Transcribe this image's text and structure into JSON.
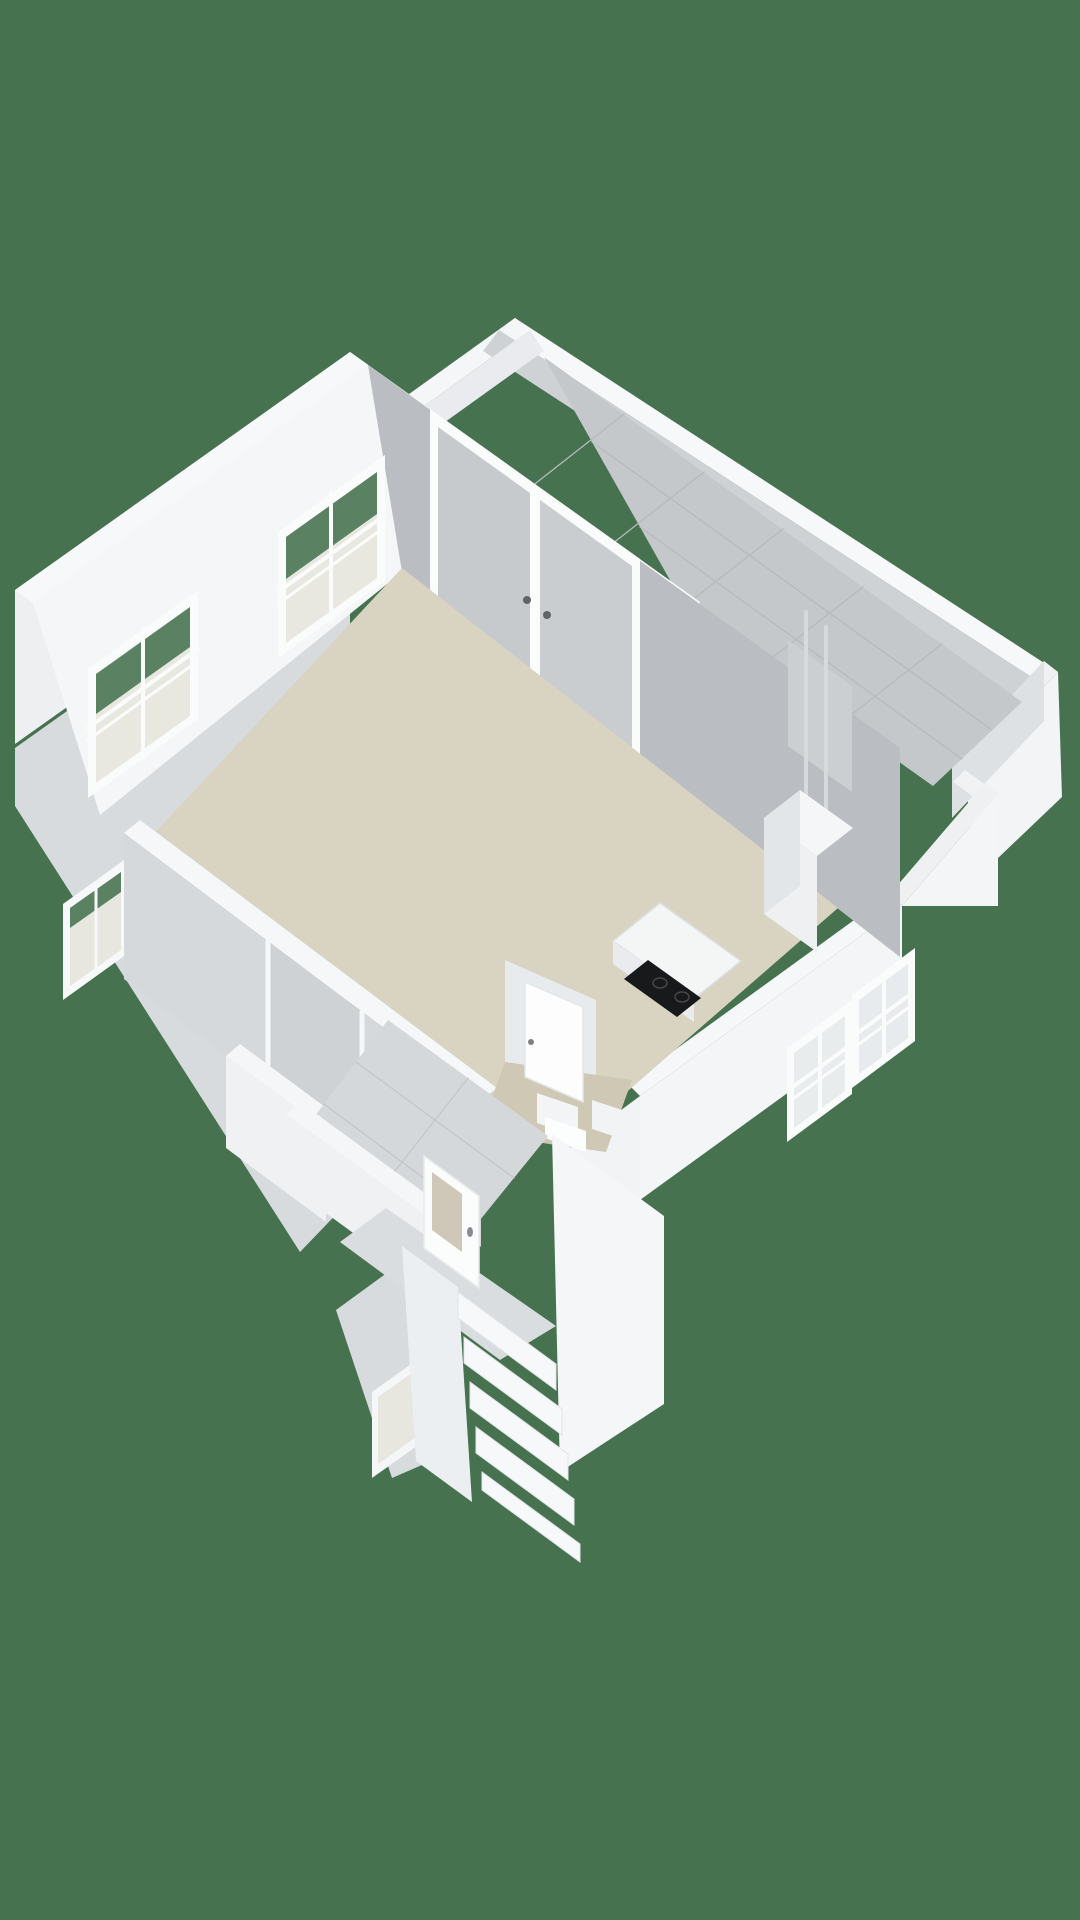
{
  "meta": {
    "view_label": "3d-floorplan-render",
    "background_color": "#47724f",
    "canvas": {
      "width": 1080,
      "height": 1920
    }
  },
  "palette": {
    "background_green": "#47724f",
    "wall_top_white": "#f7f8f9",
    "wall_light": "#f3f5f6",
    "wall_mid": "#eceff1",
    "wall_shadow": "#babec3",
    "wall_shadow_soft": "#d6d9dc",
    "floor_beige": "#d9d3c2",
    "floor_beige_dark": "#cfc8b5",
    "tile_gray": "#c5c8cb",
    "tile_line": "#b7babd",
    "hall_tile": "#d5d8da",
    "glass_gray": "#c7cbcf",
    "glass_pale": "#e9e8e0",
    "glass_green": "#5b8163",
    "cooktop_black": "#17191b",
    "door_glass_beige": "#cfc8b8",
    "shoe_dark": "#28292b",
    "shoe_brown": "#8a4a38"
  },
  "scene": {
    "shapes": [
      {
        "t": "poly",
        "n": "terrace-se-outer-wall",
        "p": "1058,672 965,770 975,880 1062,797",
        "f": "#f2f4f5"
      },
      {
        "t": "poly",
        "n": "terrace-ne-parapet-band",
        "p": "515,318 1058,672 1042,684 499,330",
        "f": "#f7f8f9"
      },
      {
        "t": "poly",
        "n": "terrace-nw-parapet-band",
        "p": "515,318 352,435 367,447 530,330",
        "f": "#f5f6f7"
      },
      {
        "t": "poly",
        "n": "terrace-se-parapet-band",
        "p": "1058,672 965,770 952,758 1044,661",
        "f": "#eff1f3"
      },
      {
        "t": "poly",
        "n": "terrace-ne-parapet-inner",
        "p": "499,330 1042,684 1026,705 483,351",
        "f": "#ced2d5"
      },
      {
        "t": "poly",
        "n": "terrace-nw-parapet-inner",
        "p": "530,330 367,447 381,468 544,351",
        "f": "#e9ebee"
      },
      {
        "t": "poly",
        "n": "terrace-se-parapet-inner",
        "p": "1044,661 952,758 952,818 1044,721",
        "f": "#dee1e4"
      },
      {
        "t": "poly",
        "n": "terrace-corner-hook",
        "p": "965,770 998,794 986,806 953,782",
        "f": "#f0f2f4"
      },
      {
        "t": "poly",
        "n": "terrace-diagonal-wall-band",
        "p": "998,794 902,906 890,894 986,782",
        "f": "#eef0f2"
      },
      {
        "t": "poly",
        "n": "terrace-diagonal-wall-face",
        "p": "998,794 902,906 998,906",
        "f": "#f3f5f6"
      },
      {
        "t": "poly",
        "n": "terrace-tile-floor",
        "p": "544,357 1022,702 933,786 688,612",
        "f": "#c5c8cb"
      },
      {
        "t": "line",
        "n": "terrace-tile-line",
        "p": "592,442 992,730",
        "s": "#b7babd",
        "w": 1.3
      },
      {
        "t": "line",
        "n": "terrace-tile-line",
        "p": "640,527 962,759",
        "s": "#b7babd",
        "w": 1.3
      },
      {
        "t": "line",
        "n": "terrace-tile-line",
        "p": "624,414 522,494",
        "s": "#b7babd",
        "w": 1.3
      },
      {
        "t": "line",
        "n": "terrace-tile-line",
        "p": "704,472 603,551",
        "s": "#b7babd",
        "w": 1.3
      },
      {
        "t": "line",
        "n": "terrace-tile-line",
        "p": "783,529 682,608",
        "s": "#b7babd",
        "w": 1.3
      },
      {
        "t": "line",
        "n": "terrace-tile-line",
        "p": "863,587 763,665",
        "s": "#b7babd",
        "w": 1.3
      },
      {
        "t": "line",
        "n": "terrace-tile-line",
        "p": "942,644 842,722",
        "s": "#b7babd",
        "w": 1.3
      },
      {
        "t": "poly",
        "n": "north-wall-terrace-face",
        "p": "350,352 700,602 686,650 336,400",
        "f": "#fbfcfd"
      },
      {
        "t": "poly",
        "n": "west-wall-outer",
        "p": "350,352 15,590 15,744 350,506",
        "f": "#edeff1"
      },
      {
        "t": "poly",
        "n": "annex-west-outer-wall",
        "p": "350,510 15,748 15,806 300,1252 350,1200",
        "f": "#d8dbde"
      },
      {
        "t": "poly",
        "n": "stairs-left-outer-wall",
        "p": "424,1246 336,1310 392,1478 452,1452",
        "f": "#d8dbde"
      },
      {
        "t": "poly",
        "n": "north-wall-top-band",
        "p": "350,352 700,602 683,616 333,366",
        "f": "#f7f8f9"
      },
      {
        "t": "poly",
        "n": "west-wall-top-band",
        "p": "350,352 15,590 33,603 368,365",
        "f": "#f7f8f9"
      },
      {
        "t": "poly",
        "n": "se-wall-top-band",
        "p": "902,906 640,1096 628,1084 890,894",
        "f": "#f6f7f8"
      },
      {
        "t": "poly",
        "n": "se-wall-outer-face",
        "p": "902,906 640,1096 640,1200 902,1010",
        "f": "#f3f5f6"
      },
      {
        "t": "poly",
        "n": "se-annex-outer-face",
        "p": "640,1096 556,1158 556,1286 640,1224",
        "f": "#f1f3f5"
      },
      {
        "t": "poly",
        "n": "window-se1-frame",
        "p": "915,948 852,995 852,1088 915,1041",
        "f": "#fafbfb"
      },
      {
        "t": "poly",
        "n": "window-se1-glass",
        "p": "908,964 859,1000 859,1074 908,1038",
        "f": "#e8ebed"
      },
      {
        "t": "line",
        "n": "window-se1-muntin",
        "p": "884,982 884,1056",
        "s": "#fafbfb",
        "w": 4
      },
      {
        "t": "line",
        "n": "window-se1-muntin",
        "p": "908,996 859,1032",
        "s": "#fafbfb",
        "w": 4
      },
      {
        "t": "line",
        "n": "window-se1-muntin",
        "p": "908,1008 859,1044",
        "s": "#fafbfb",
        "w": 3
      },
      {
        "t": "poly",
        "n": "window-se2-frame",
        "p": "852,1000 787,1048 787,1142 852,1094",
        "f": "#fafbfb"
      },
      {
        "t": "poly",
        "n": "window-se2-glass",
        "p": "845,1016 794,1053 794,1128 845,1091",
        "f": "#e9eced"
      },
      {
        "t": "line",
        "n": "window-se2-muntin",
        "p": "820,1034 820,1110",
        "s": "#fafbfb",
        "w": 4
      },
      {
        "t": "line",
        "n": "window-se2-muntin",
        "p": "845,1049 794,1086",
        "s": "#fafbfb",
        "w": 4
      },
      {
        "t": "line",
        "n": "window-se2-muntin",
        "p": "845,1061 794,1098",
        "s": "#fafbfb",
        "w": 3
      },
      {
        "t": "poly",
        "n": "living-ne-wall-inner",
        "p": "368,365 900,748 900,957 368,542",
        "f": "#babec3"
      },
      {
        "t": "poly",
        "n": "french-doors-frame",
        "p": "430,409 640,559 640,755 430,590",
        "f": "#fafbfb"
      },
      {
        "t": "poly",
        "n": "french-door-glass-left",
        "p": "438,427 530,493 530,705 438,612",
        "f": "#c6cacd"
      },
      {
        "t": "poly",
        "n": "french-door-glass-right",
        "p": "540,500 632,566 632,748 540,682",
        "f": "#c9cdd0"
      },
      {
        "t": "ellipse",
        "n": "french-door-handle",
        "cx": 527,
        "cy": 600,
        "rx": 4,
        "ry": 4,
        "f": "#606468"
      },
      {
        "t": "ellipse",
        "n": "french-door-handle",
        "cx": 547,
        "cy": 615,
        "rx": 4,
        "ry": 4,
        "f": "#606468"
      },
      {
        "t": "poly",
        "n": "west-wall-inner-strip",
        "p": "368,365 33,603 100,815 402,572",
        "f": "#f5f6f7"
      },
      {
        "t": "poly",
        "n": "window-w1-frame",
        "p": "385,455 278,532 278,658 385,581",
        "f": "#fafbfb"
      },
      {
        "t": "poly",
        "n": "window-w1-glass",
        "p": "377,472 286,537 286,643 377,578",
        "f": "#e9e8e0"
      },
      {
        "t": "poly",
        "n": "window-w1-glass-green",
        "p": "377,472 286,537 286,579 377,514",
        "f": "#5b8163"
      },
      {
        "t": "line",
        "n": "window-w1-muntin",
        "p": "331,493 331,620",
        "s": "#fafbfb",
        "w": 4
      },
      {
        "t": "line",
        "n": "window-w1-muntin",
        "p": "385,515 278,592",
        "s": "#fafbfb",
        "w": 4
      },
      {
        "t": "line",
        "n": "window-w1-muntin",
        "p": "385,527 278,604",
        "s": "#fafbfb",
        "w": 3
      },
      {
        "t": "poly",
        "n": "window-w2-frame",
        "p": "198,590 88,669 88,798 198,719",
        "f": "#fafbfb"
      },
      {
        "t": "poly",
        "n": "window-w2-glass",
        "p": "190,607 96,674 96,783 190,716",
        "f": "#e9e8e0"
      },
      {
        "t": "poly",
        "n": "window-w2-glass-green",
        "p": "190,607 96,674 96,714 190,647",
        "f": "#5b8163"
      },
      {
        "t": "line",
        "n": "window-w2-muntin",
        "p": "143,628 143,758",
        "s": "#fafbfb",
        "w": 4
      },
      {
        "t": "line",
        "n": "window-w2-muntin",
        "p": "198,649 88,728",
        "s": "#fafbfb",
        "w": 4
      },
      {
        "t": "line",
        "n": "window-w2-muntin",
        "p": "198,661 88,740",
        "s": "#fafbfb",
        "w": 3
      },
      {
        "t": "poly",
        "n": "window-w3-frame",
        "p": "127,858 63,904 63,1000 127,954",
        "f": "#f7f8f9"
      },
      {
        "t": "poly",
        "n": "window-w3-glass",
        "p": "121,872 70,908 70,986 121,950",
        "f": "#e7e6df"
      },
      {
        "t": "poly",
        "n": "window-w3-glass-green",
        "p": "121,872 70,908 70,928 121,892",
        "f": "#5b8163"
      },
      {
        "t": "line",
        "n": "window-w3-muntin",
        "p": "96,888 96,970",
        "s": "#f7f8f9",
        "w": 3
      },
      {
        "t": "poly",
        "n": "window-w4-frame",
        "p": "428,1352 372,1392 372,1478 428,1438",
        "f": "#f5f6f7"
      },
      {
        "t": "poly",
        "n": "window-w4-glass",
        "p": "422,1366 378,1397 378,1464 422,1433",
        "f": "#e7e6df"
      },
      {
        "t": "poly",
        "n": "living-room-floor",
        "p": "402,568 838,908 560,1150 150,838",
        "f": "#d9d3c2"
      },
      {
        "t": "poly",
        "n": "heatpump-wall-panel",
        "p": "788,640 852,686 852,792 788,746",
        "f": "#cbcfd2"
      },
      {
        "t": "line",
        "n": "heatpump-pipe",
        "p": "806,612 806,830",
        "s": "#d7dadd",
        "w": 4
      },
      {
        "t": "line",
        "n": "heatpump-pipe",
        "p": "826,627 826,846",
        "s": "#d7dadd",
        "w": 4
      },
      {
        "t": "poly",
        "n": "heatpump-top",
        "p": "800,790 853,828 817,856 764,818",
        "f": "#f5f6f7"
      },
      {
        "t": "poly",
        "n": "heatpump-front",
        "p": "764,818 817,856 817,952 764,914",
        "f": "#eef0f2"
      },
      {
        "t": "poly",
        "n": "heatpump-side",
        "p": "800,790 764,818 764,914 800,886",
        "f": "#e3e6e9"
      },
      {
        "t": "poly",
        "n": "kitchen-counter-top",
        "p": "660,903 741,961 694,999 613,941",
        "f": "#f4f5f5",
        "s": "#dcdfe2",
        "w": 1.5
      },
      {
        "t": "poly",
        "n": "kitchen-counter-front",
        "p": "613,941 694,999 694,1022 613,964",
        "f": "#e9ebee"
      },
      {
        "t": "poly",
        "n": "cooktop",
        "p": "648,960 701,998 677,1017 624,979",
        "f": "#17191b"
      },
      {
        "t": "ellipse",
        "n": "cooktop-burner",
        "cx": 660,
        "cy": 983,
        "rx": 7,
        "ry": 5,
        "f": "none",
        "s": "#43474b",
        "w": 1.5
      },
      {
        "t": "ellipse",
        "n": "cooktop-burner",
        "cx": 682,
        "cy": 997,
        "rx": 7,
        "ry": 5,
        "f": "none",
        "s": "#43474b",
        "w": 1.5
      },
      {
        "t": "poly",
        "n": "south-wall-top-band",
        "p": "140,820 497,1088 481,1101 124,833",
        "f": "#f6f7f8"
      },
      {
        "t": "poly",
        "n": "south-wall-inner-face",
        "p": "124,833 481,1101 481,1247 124,979",
        "f": "#d6d9dc"
      },
      {
        "t": "poly",
        "n": "hall-doorway-opening",
        "p": "268,941 362,1012 362,1140 268,1069",
        "f": "#cfd2d5"
      },
      {
        "t": "line",
        "n": "hall-doorway-jamb",
        "p": "268,941 268,1069",
        "s": "#f6f7f8",
        "w": 5
      },
      {
        "t": "line",
        "n": "hall-doorway-jamb",
        "p": "362,1012 362,1140",
        "s": "#f6f7f8",
        "w": 5
      },
      {
        "t": "poly",
        "n": "hall-west-wall-band",
        "p": "240,1044 340,1118 326,1130 226,1056",
        "f": "#f5f6f7"
      },
      {
        "t": "poly",
        "n": "hall-west-wall-face",
        "p": "226,1056 326,1130 326,1222 226,1148",
        "f": "#eff1f3"
      },
      {
        "t": "poly",
        "n": "meter-niche-back",
        "p": "334,1136 398,1150 398,1205 334,1191",
        "f": "#f1f2f4"
      },
      {
        "t": "poly",
        "n": "meter-niche-floor",
        "p": "340,1168 394,1180 386,1208 332,1196",
        "f": "#e3e6e8"
      },
      {
        "t": "poly",
        "n": "meter-niche-object",
        "p": "344,1180 357,1185 353,1197 340,1192",
        "f": "#28292b"
      },
      {
        "t": "poly",
        "n": "meter-niche-object",
        "p": "356,1170 369,1175 365,1187 352,1182",
        "f": "#323436"
      },
      {
        "t": "poly",
        "n": "meter-niche-object",
        "p": "366,1158 378,1163 374,1174 362,1169",
        "f": "#8a4a38"
      },
      {
        "t": "poly",
        "n": "meter-niche-object",
        "p": "376,1148 388,1153 384,1164 372,1159",
        "f": "#7a4030"
      },
      {
        "t": "poly",
        "n": "toilet-room-wall",
        "p": "505,960 596,1000 596,1135 505,1095",
        "f": "#e8ebed"
      },
      {
        "t": "poly",
        "n": "toilet-room-floor",
        "p": "505,1062 632,1080 606,1152 479,1134",
        "f": "#cfc8b5"
      },
      {
        "t": "poly",
        "n": "toilet-door",
        "p": "525,982 583,1007 583,1102 525,1077",
        "f": "#fdfdfe",
        "s": "#e4e7e9",
        "w": 1.5
      },
      {
        "t": "ellipse",
        "n": "toilet-door-handle",
        "cx": 531,
        "cy": 1042,
        "rx": 3,
        "ry": 3,
        "f": "#7d8184"
      },
      {
        "t": "poly",
        "n": "toilet-cistern",
        "p": "537,1093 578,1107 578,1137 537,1123",
        "f": "#f3f4f5"
      },
      {
        "t": "poly",
        "n": "toilet-bowl",
        "p": "545,1117 586,1131 586,1152 545,1138",
        "f": "#fcfdfd"
      },
      {
        "t": "poly",
        "n": "toilet-basin",
        "p": "592,1100 628,1112 628,1141 592,1129",
        "f": "#f1f3f4"
      },
      {
        "t": "poly",
        "n": "hall-tile-floor",
        "p": "388,1020 548,1136 446,1262 292,1146",
        "f": "#d5d8da"
      },
      {
        "t": "line",
        "n": "hall-tile-line",
        "p": "356,1062 514,1178",
        "s": "#c3c7ca",
        "w": 1.3
      },
      {
        "t": "line",
        "n": "hall-tile-line",
        "p": "324,1104 480,1220",
        "s": "#c3c7ca",
        "w": 1.3
      },
      {
        "t": "line",
        "n": "hall-tile-line",
        "p": "468,1078 369,1204",
        "s": "#c3c7ca",
        "w": 1.3
      },
      {
        "t": "poly",
        "n": "hall-sw-wall-band",
        "p": "300,1102 470,1226 456,1238 286,1114",
        "f": "#f5f6f7"
      },
      {
        "t": "poly",
        "n": "hall-sw-wall-face",
        "p": "286,1114 456,1238 456,1308 286,1184",
        "f": "#eff1f3"
      },
      {
        "t": "poly",
        "n": "entry-landing",
        "p": "386,1208 556,1326 500,1360 340,1242",
        "f": "#dadde0"
      },
      {
        "t": "poly",
        "n": "front-door",
        "p": "424,1156 479,1196 479,1288 424,1248",
        "f": "#fbfcfc",
        "s": "#e8eaec",
        "w": 1.5
      },
      {
        "t": "poly",
        "n": "front-door-glass",
        "p": "432,1172 462,1194 462,1252 432,1230",
        "f": "#cfc8b8"
      },
      {
        "t": "ellipse",
        "n": "front-door-handle",
        "cx": 470,
        "cy": 1232,
        "rx": 3,
        "ry": 5,
        "f": "#888c90"
      },
      {
        "t": "poly",
        "n": "stairs-left-wall",
        "p": "402,1246 458,1287 472,1502 416,1461",
        "f": "#eceff1"
      },
      {
        "t": "poly",
        "n": "stairs-right-wall",
        "p": "552,1134 664,1216 664,1404 560,1472",
        "f": "#f4f6f7"
      },
      {
        "t": "poly",
        "n": "stair-riser",
        "p": "458,1292 556,1364 556,1390 458,1318",
        "f": "#f6f8f9",
        "s": "#e2e5e8",
        "w": 1
      },
      {
        "t": "poly",
        "n": "stair-riser",
        "p": "464,1337 562,1409 562,1435 464,1363",
        "f": "#f6f8f9",
        "s": "#e2e5e8",
        "w": 1
      },
      {
        "t": "poly",
        "n": "stair-riser",
        "p": "470,1382 568,1454 568,1480 470,1408",
        "f": "#f6f8f9",
        "s": "#e2e5e8",
        "w": 1
      },
      {
        "t": "poly",
        "n": "stair-riser",
        "p": "476,1427 574,1499 574,1525 476,1453",
        "f": "#f6f8f9",
        "s": "#e2e5e8",
        "w": 1
      },
      {
        "t": "poly",
        "n": "stair-riser",
        "p": "482,1472 580,1544 580,1562 482,1490",
        "f": "#f6f8f9",
        "s": "#e2e5e8",
        "w": 1
      }
    ]
  }
}
